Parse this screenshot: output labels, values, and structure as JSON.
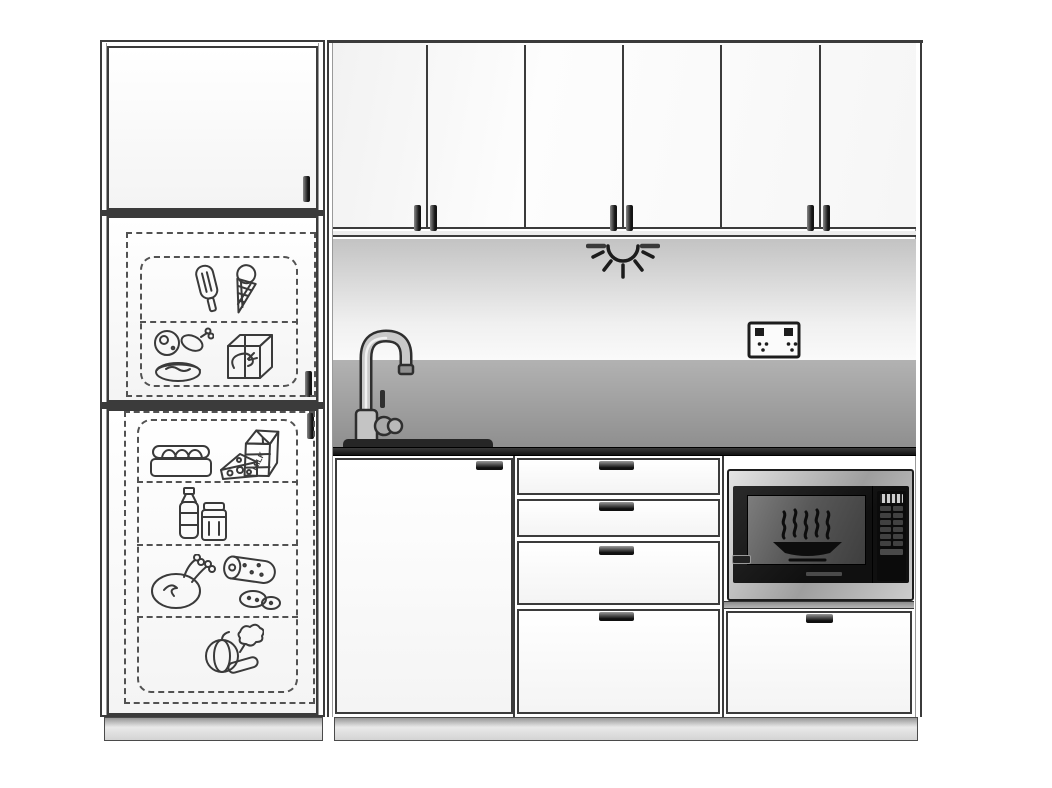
{
  "figure": {
    "type": "kitchen-elevation-line-drawing",
    "labels": {
      "milk_carton": "MILK"
    },
    "tall_unit": {
      "name": "fridge-freezer-tower",
      "top_cabinet_doors": 1,
      "freezer": {
        "shelves": [
          {
            "items": [
              "popsicle",
              "ice-cream-cone"
            ]
          },
          {
            "items": [
              "ham-and-drumstick",
              "frozen-seafood-cube"
            ]
          }
        ]
      },
      "fridge": {
        "shelves": [
          {
            "items": [
              "egg-tray",
              "cheese-wedge",
              "milk-carton"
            ]
          },
          {
            "items": [
              "water-bottle",
              "storage-jar"
            ]
          },
          {
            "items": [
              "roast-chicken",
              "salami-with-slices"
            ]
          },
          {
            "items": [
              "pumpkin",
              "cucumber",
              "leafy-greens"
            ]
          }
        ]
      }
    },
    "wall_units": {
      "doors": 6,
      "handle_pairs": 3
    },
    "fixtures": {
      "under_cabinet_light": "downlight-symbol",
      "power_outlet": "double-switched-socket",
      "tap": "gooseneck-mixer-tap",
      "sink": "inset-sink"
    },
    "base_units": {
      "sink_cabinet_doors": 1,
      "drawer_stack_drawers": 4,
      "appliance_tower": {
        "appliance": "built-in-microwave",
        "drawers": 1
      }
    },
    "microwave": {
      "finish": "stainless-steel",
      "door_graphic": "steaming-bowl",
      "panel": {
        "has_display": true,
        "button_count": 12
      }
    },
    "colors": {
      "background": "#ffffff",
      "linework": "#3a3a3a",
      "counter": "#1c1c1c",
      "splashback": "#9d9d9d",
      "under_cabinet_shadow": "#c6c6c6",
      "plinth": "#d6d6d6",
      "stainless": "#b9b9b9",
      "microwave_door": "#141414"
    }
  }
}
